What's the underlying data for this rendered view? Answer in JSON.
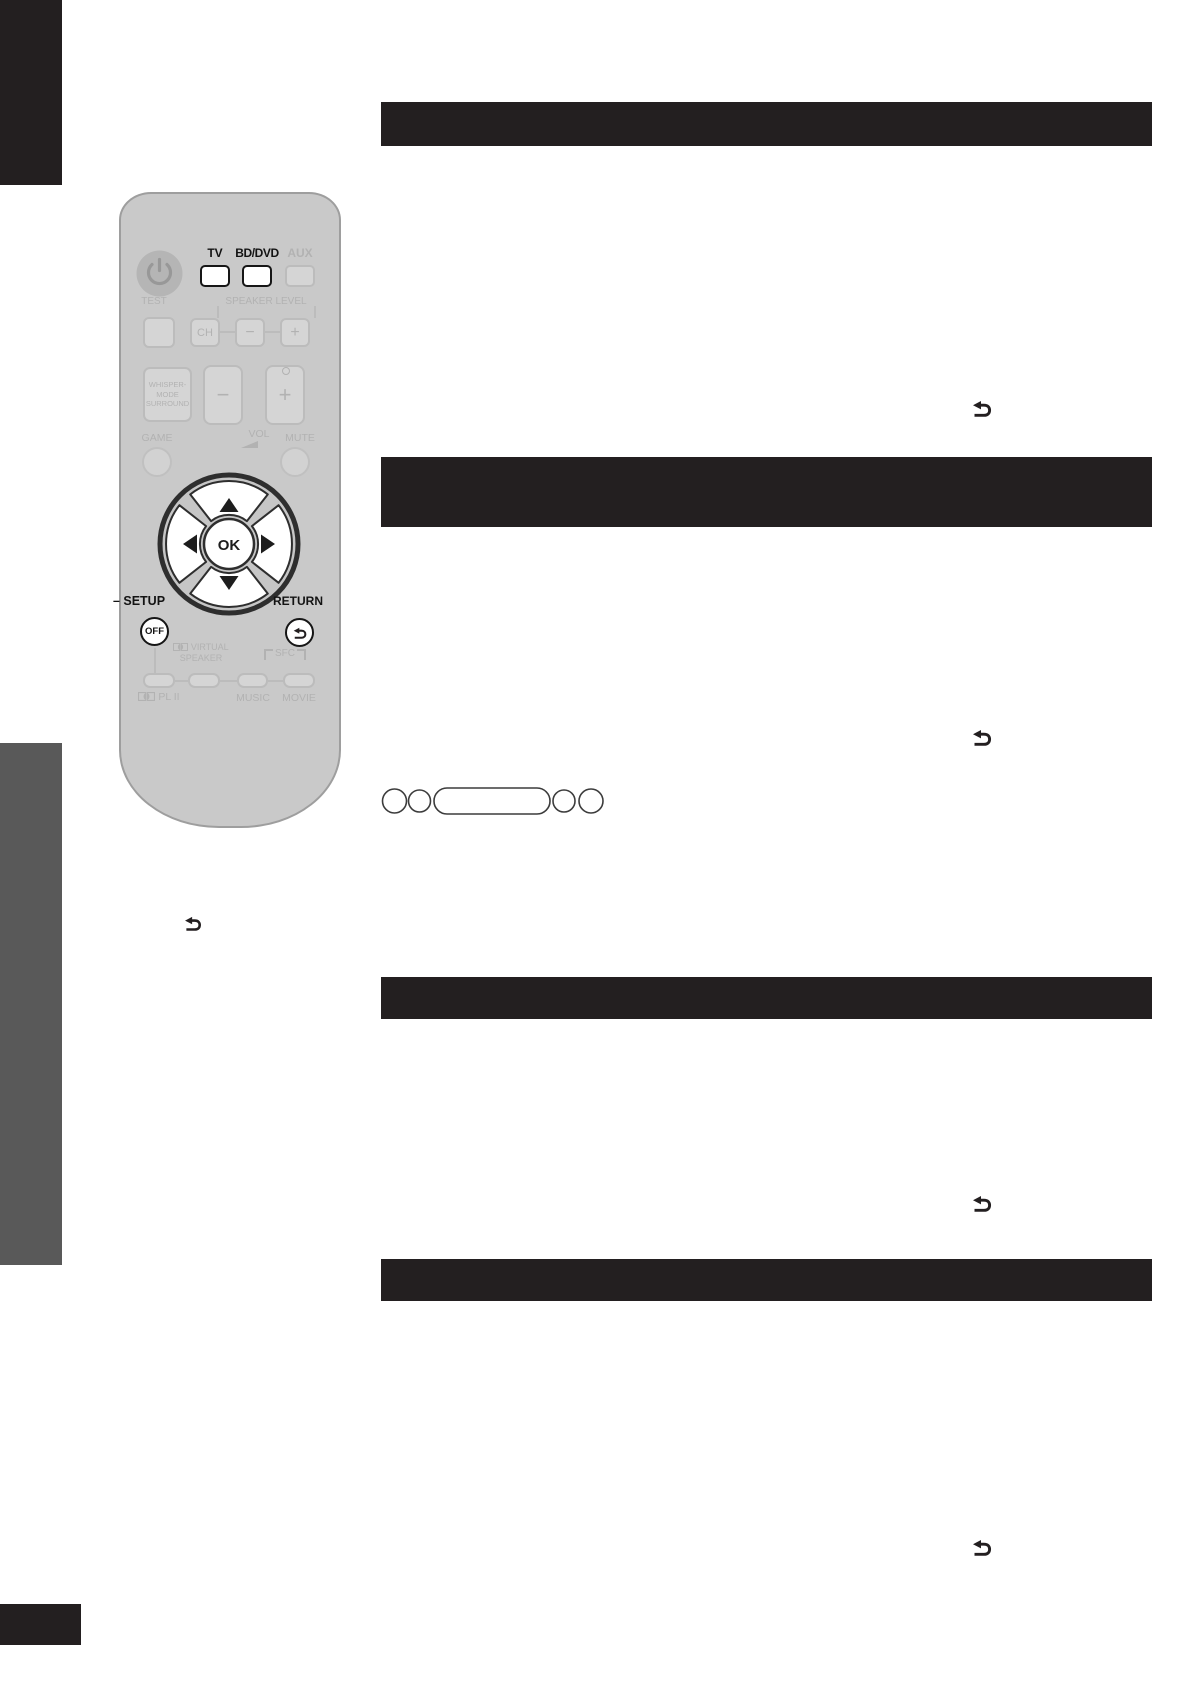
{
  "colors": {
    "section_bar": "#231f20",
    "left_tab_black": "#231f20",
    "left_tab_gray": "#595959",
    "remote_body": "#c9c9c9",
    "remote_faded_gray": "#b2b2b2",
    "remote_active_black": "#161616"
  },
  "section_bars": {
    "count": 4,
    "text": ""
  },
  "remote": {
    "device_buttons": {
      "tv": "TV",
      "bddvd": "BD/DVD",
      "aux": "AUX"
    },
    "test": "TEST",
    "speaker_level": "SPEAKER LEVEL",
    "ch": "CH",
    "speaker_minus": "−",
    "speaker_plus": "+",
    "whisper_line1": "WHISPER-",
    "whisper_line2": "MODE",
    "whisper_line3": "SURROUND",
    "vol_minus": "−",
    "vol_plus": "+",
    "game": "GAME",
    "vol": "VOL",
    "mute": "MUTE",
    "ok": "OK",
    "setup": "– SETUP",
    "return_label": "RETURN",
    "off": "OFF",
    "virtual": "VIRTUAL",
    "speaker": "SPEAKER",
    "sfc": "SFC",
    "pl2": "PL II",
    "music": "MUSIC",
    "movie": "MOVIE"
  },
  "icons": {
    "return_icon": "curved-return-arrow",
    "power_icon": "power-symbol",
    "dolby_icon": "dolby-double-d",
    "nav_arrows": "up-down-left-right-triangles",
    "vol_wedge": "rising-volume-wedge"
  }
}
